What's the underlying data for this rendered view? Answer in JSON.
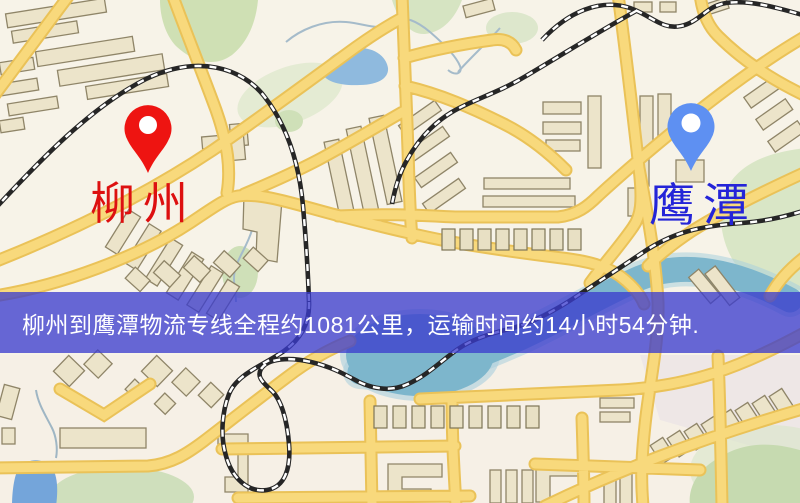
{
  "map": {
    "origin": {
      "label": "柳州",
      "pin_color": "#ee1411",
      "label_color": "#dd1010",
      "pin_style": "red-marker"
    },
    "destination": {
      "label": "鹰潭",
      "pin_color": "#5e90f2",
      "label_color": "#2424d8",
      "pin_style": "blue-marker"
    },
    "banner": {
      "text": "柳州到鹰潭物流专线全程约1081公里，运输时间约14小时54分钟.",
      "background_color": "rgba(58,60,205,0.77)",
      "text_color": "#ffffff"
    },
    "route_info": {
      "origin": "柳州",
      "destination": "鹰潭",
      "distance_text": "全程约1081公里",
      "duration_text": "运输时间约14小时54分钟"
    },
    "palette": {
      "background": "#f7f3e8",
      "road_fill": "#f8d97c",
      "road_edge": "#eac258",
      "building_fill": "#ece4ca",
      "building_outline": "#8f8568",
      "park_green": "#cfe0b4",
      "water_blue": "#8fbade",
      "pond_teal": "#7db6cc",
      "railway_dark": "#262626"
    }
  }
}
